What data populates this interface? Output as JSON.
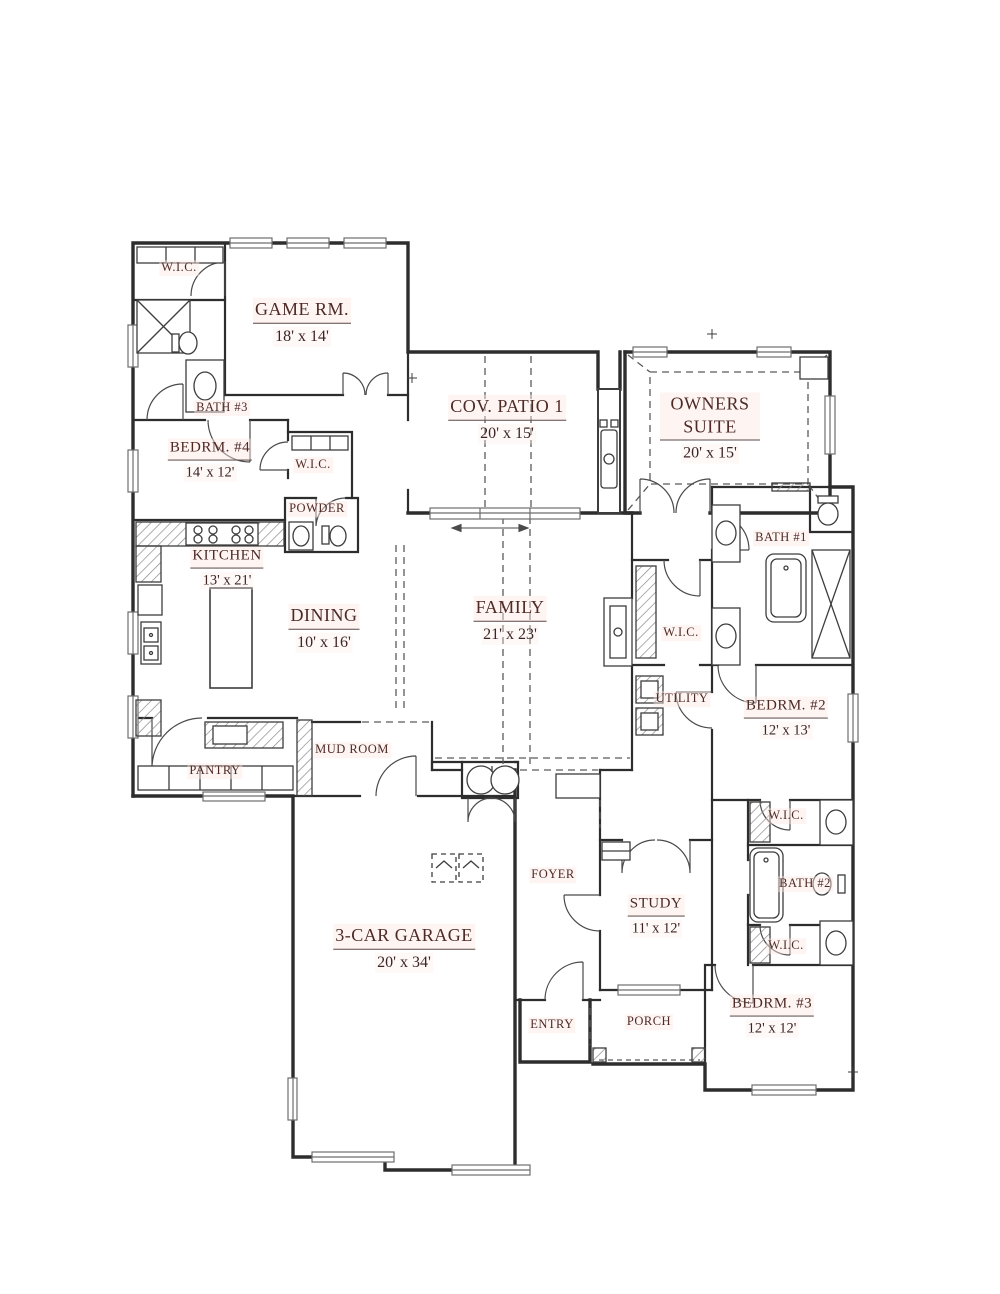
{
  "colors": {
    "wall": "#2d2d2d",
    "thin_line": "#555555",
    "label": "#4e2a26",
    "dims": "#3c2523",
    "window": "#6e6e6e"
  },
  "rooms": {
    "wic_game": {
      "name": "W.I.C."
    },
    "game_room": {
      "name": "GAME RM.",
      "dims": "18' x 14'"
    },
    "bath3": {
      "name": "BATH #3"
    },
    "bedroom4": {
      "name": "BEDRM. #4",
      "dims": "14' x 12'"
    },
    "wic_bed4": {
      "name": "W.I.C."
    },
    "powder": {
      "name": "POWDER"
    },
    "cov_patio": {
      "name": "COV. PATIO 1",
      "dims": "20' x 15'"
    },
    "owners": {
      "name": "OWNERS SUITE",
      "dims": "20' x 15'"
    },
    "bath1": {
      "name": "BATH #1"
    },
    "kitchen": {
      "name": "KITCHEN",
      "dims": "13' x 21'"
    },
    "dining": {
      "name": "DINING",
      "dims": "10' x 16'"
    },
    "family": {
      "name": "FAMILY",
      "dims": "21' x 23'"
    },
    "wic_owners": {
      "name": "W.I.C."
    },
    "utility": {
      "name": "UTILITY"
    },
    "bedroom2": {
      "name": "BEDRM. #2",
      "dims": "12' x 13'"
    },
    "pantry": {
      "name": "PANTRY"
    },
    "mud_room": {
      "name": "MUD ROOM"
    },
    "wic_bed2": {
      "name": "W.I.C."
    },
    "bath2": {
      "name": "BATH #2"
    },
    "wic_bed3": {
      "name": "W.I.C."
    },
    "garage": {
      "name": "3-CAR GARAGE",
      "dims": "20' x 34'"
    },
    "foyer": {
      "name": "FOYER"
    },
    "study": {
      "name": "STUDY",
      "dims": "11' x 12'"
    },
    "entry": {
      "name": "ENTRY"
    },
    "porch": {
      "name": "PORCH"
    },
    "bedroom3": {
      "name": "BEDRM. #3",
      "dims": "12' x 12'"
    }
  }
}
